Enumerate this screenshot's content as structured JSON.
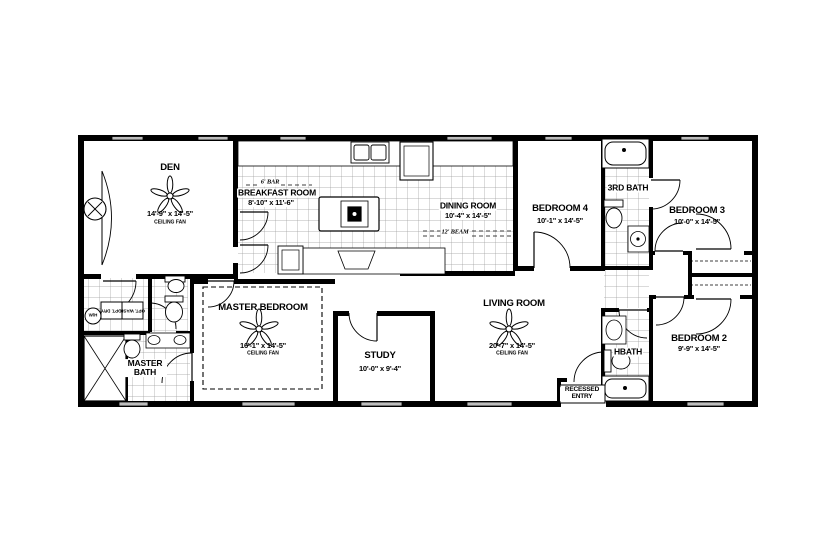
{
  "plan": {
    "background": "#ffffff",
    "wall_color": "#000000",
    "window_fill": "#bdbdbd",
    "tile_line_color": "#8a8a8a"
  },
  "rooms": {
    "den": {
      "name": "DEN",
      "dims": "14'-9\" x 14'-5\"",
      "note": "CEILING FAN"
    },
    "breakfast": {
      "name": "BREAKFAST ROOM",
      "dims": "8'-10\" x 11'-6\"",
      "note": "6' BAR"
    },
    "dining": {
      "name": "DINING ROOM",
      "dims": "10'-4\" x 14'-5\"",
      "note": "12' BEAM"
    },
    "bedroom4": {
      "name": "BEDROOM 4",
      "dims": "10'-1\" x 14'-5\""
    },
    "third_bath": {
      "name": "3RD BATH"
    },
    "bedroom3": {
      "name": "BEDROOM 3",
      "dims": "10'-0\" x 14'-5\""
    },
    "master_bedroom": {
      "name": "MASTER BEDROOM",
      "dims": "16'-1\" x 14'-5\"",
      "note": "CEILING FAN"
    },
    "study": {
      "name": "STUDY",
      "dims": "10'-0\" x 9'-4\""
    },
    "living": {
      "name": "LIVING ROOM",
      "dims": "20'-7\" x 14'-5\"",
      "note": "CEILING FAN"
    },
    "master_bath": {
      "name": "MASTER BATH"
    },
    "hbath": {
      "name": "HBATH"
    },
    "bedroom2": {
      "name": "BEDROOM 2",
      "dims": "9'-9\" x 14'-5\""
    },
    "entry": {
      "name": "RECESSED ENTRY"
    }
  },
  "annotations": {
    "opt_dry": "OPT. DRY.",
    "opt_wash": "OPT. WASH.",
    "water_heater": "W/H"
  }
}
